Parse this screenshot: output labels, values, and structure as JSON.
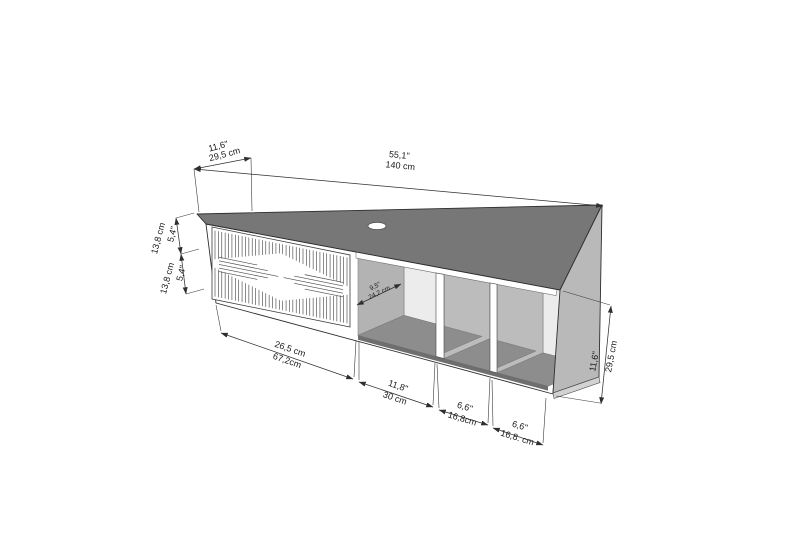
{
  "diagram": {
    "product": "wall-mounted tv-stand dimension drawing",
    "colors": {
      "top_panel": "#777777",
      "right_cap": "#b9b9b9",
      "inner_wall": "#b3b3b3",
      "shelf_floor": "#8d8d8d",
      "back_wall": "#ececec",
      "bottom_band": "#6e6e6e",
      "line": "#2f2f2f",
      "background": "#ffffff"
    },
    "dims": {
      "top_depth": {
        "in": "11,6\"",
        "cm": "29,5 cm"
      },
      "top_width": {
        "in": "55,1\"",
        "cm": "140 cm"
      },
      "side_upper": {
        "in": "5,4\"",
        "cm": "13,8 cm"
      },
      "side_lower": {
        "in": "5,4\"",
        "cm": "13,8 cm"
      },
      "shelf_depth": {
        "in": "9,5\"",
        "cm": "24,2 cm"
      },
      "height": {
        "in": "11,6\"",
        "cm": "29,5 cm"
      },
      "bottom_door": {
        "in": "26,5 cm",
        "cm": "67,2cm"
      },
      "bottom_shelf1": {
        "in": "11,8\"",
        "cm": "30 cm"
      },
      "bottom_shelf2": {
        "in": "6,6\"",
        "cm": "16,8cm"
      },
      "bottom_shelf3": {
        "in": "6,6\"",
        "cm": "16,8. cm"
      }
    }
  }
}
